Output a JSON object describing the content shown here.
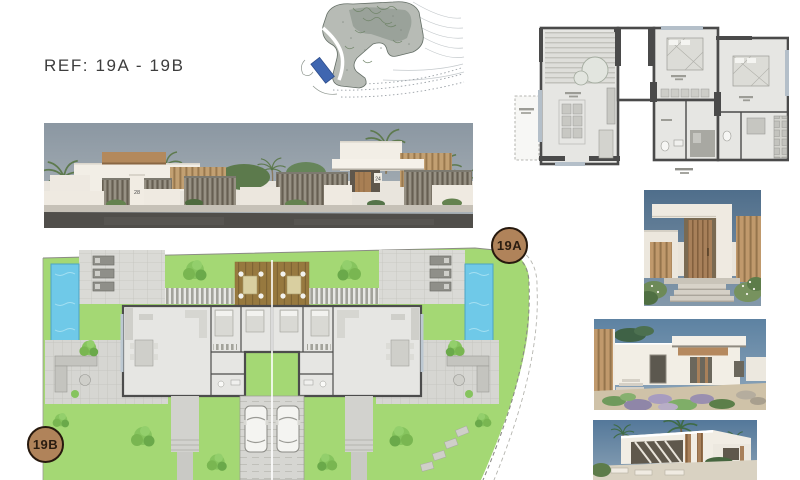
{
  "page": {
    "ref_label": "REF: 19A - 19B",
    "background": "#ffffff"
  },
  "badges": {
    "unit_a": "19A",
    "unit_b": "19B",
    "fill": "#b0835a",
    "border": "#27190e",
    "text_color": "#2a1c10"
  },
  "street_view": {
    "gate_number_left": "28",
    "gate_number_right": "24",
    "sky": "#93a0aa",
    "road": "#504e4a",
    "wall_white": "#f2eee6",
    "wood": "#b3895c"
  },
  "location_map": {
    "plot_fill": "#b7bbb5",
    "pool": "#3f66b0",
    "contour": "#c4c9cc"
  },
  "floor_plan": {
    "wall": "#4a4a4a",
    "floor": "#e6e6e3",
    "window": "#b4bfc9"
  },
  "site_plan": {
    "lawn": "#a4d874",
    "pool": "#6fc9e8",
    "deck": "#97793f",
    "paving": "#dadad6",
    "wall": "#4c4c4c",
    "tree": "#86c45e"
  },
  "renders": {
    "entrance_sky": "#4f6e8b",
    "side_sky": "#6e90ad",
    "pool_sky": "#5b80a2",
    "wall_white": "#f1ede4",
    "wood": "#a8805a"
  }
}
